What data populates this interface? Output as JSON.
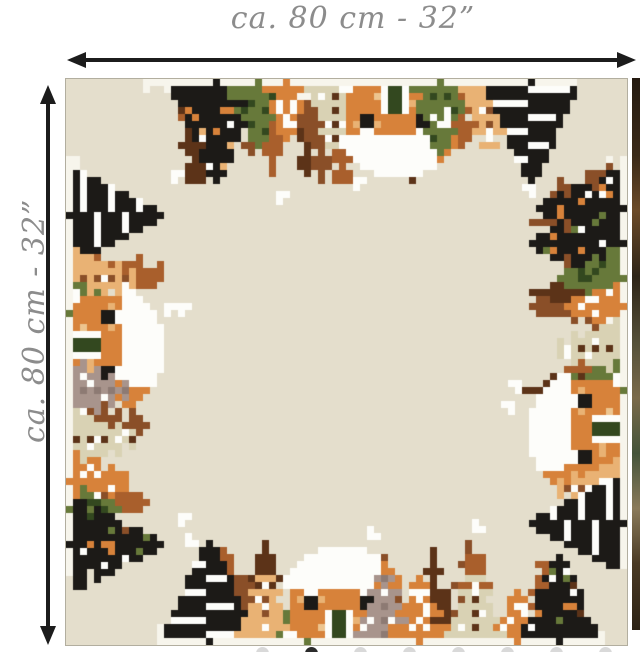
{
  "labels": {
    "width_label": "ca. 80 cm - 32”",
    "height_label": "ca. 80 cm - 32”",
    "label_color": "#8c8c8c"
  },
  "arrows": {
    "color": "#1c1c1c"
  },
  "cloth": {
    "background": "#e4decc",
    "border_color": "#b2ae9f",
    "palette": {
      "black": "#1c1a17",
      "white": "#fdfdfa",
      "snow": "#f7f5ec",
      "orange": "#d7823a",
      "tan": "#e9b274",
      "peach": "#edc58f",
      "beige": "#d9d2b4",
      "green": "#67793a",
      "darkgreen": "#33481f",
      "brown": "#8a4f28",
      "darkbrown": "#5c3318",
      "rust": "#a95f2c",
      "mauve": "#a8948c",
      "darkmauve": "#8d7a73"
    },
    "edges": {
      "top": {
        "seed": 11,
        "band": [
          0.17,
          0.88
        ],
        "fuzz": 16,
        "motifs": [
          {
            "type": "fir",
            "at": 0.26,
            "s": 1.1,
            "color": "black",
            "dots": [
              "orange",
              "white",
              "tan"
            ]
          },
          {
            "type": "fir",
            "at": 0.335,
            "s": 0.7,
            "color": "green",
            "dots": [
              "darkgreen"
            ]
          },
          {
            "type": "fir",
            "at": 0.385,
            "s": 0.6,
            "color": "orange",
            "dots": [
              "white"
            ]
          },
          {
            "type": "layered",
            "at": 0.47,
            "s": 0.85,
            "color": "beige",
            "trunk": "darkbrown"
          },
          {
            "type": "house",
            "at": 0.585
          },
          {
            "type": "fir",
            "at": 0.665,
            "s": 0.8,
            "color": "green",
            "dots": [
              "darkgreen",
              "white"
            ]
          },
          {
            "type": "layered",
            "at": 0.745,
            "s": 0.85,
            "color": "tan",
            "trunk": "brown"
          },
          {
            "type": "striped",
            "at": 0.83,
            "s": 1.0
          }
        ]
      },
      "left": {
        "seed": 22,
        "band": [
          0.17,
          0.86
        ],
        "fuzz": 13,
        "motifs": [
          {
            "type": "striped",
            "at": 0.24,
            "s": 0.95
          },
          {
            "type": "layered",
            "at": 0.35,
            "s": 0.8,
            "color": "tan",
            "trunk": "brown"
          },
          {
            "type": "fir",
            "at": 0.41,
            "s": 0.7,
            "color": "green",
            "dots": [
              "darkgreen"
            ]
          },
          {
            "type": "house",
            "at": 0.47
          },
          {
            "type": "layered",
            "at": 0.555,
            "s": 0.75,
            "color": "mauve",
            "trunk": "darkmauve"
          },
          {
            "type": "layered",
            "at": 0.64,
            "s": 0.85,
            "color": "beige",
            "trunk": "darkbrown"
          },
          {
            "type": "fir",
            "at": 0.715,
            "s": 0.65,
            "color": "orange",
            "dots": [
              "white"
            ]
          },
          {
            "type": "fir",
            "at": 0.76,
            "s": 0.55,
            "color": "green",
            "dots": [
              "darkgreen"
            ]
          },
          {
            "type": "fir",
            "at": 0.825,
            "s": 1.0,
            "color": "black",
            "dots": [
              "orange",
              "white",
              "green"
            ]
          }
        ]
      },
      "right": {
        "seed": 33,
        "band": [
          0.17,
          0.84
        ],
        "fuzz": 13,
        "motifs": [
          {
            "type": "fir",
            "at": 0.225,
            "s": 0.9,
            "color": "black",
            "dots": [
              "orange",
              "white"
            ]
          },
          {
            "type": "fir",
            "at": 0.29,
            "s": 1.0,
            "color": "black",
            "dots": [
              "orange",
              "white",
              "green"
            ]
          },
          {
            "type": "fir",
            "at": 0.345,
            "s": 0.7,
            "color": "green",
            "dots": [
              "darkgreen"
            ]
          },
          {
            "type": "fir",
            "at": 0.395,
            "s": 0.6,
            "color": "orange",
            "dots": [
              "white"
            ]
          },
          {
            "type": "layered",
            "at": 0.47,
            "s": 0.8,
            "color": "beige",
            "trunk": "darkbrown"
          },
          {
            "type": "fir",
            "at": 0.555,
            "s": 0.75,
            "color": "green",
            "dots": [
              "darkgreen"
            ]
          },
          {
            "type": "house",
            "at": 0.625
          },
          {
            "type": "layered",
            "at": 0.72,
            "s": 0.8,
            "color": "tan",
            "trunk": "brown"
          },
          {
            "type": "striped",
            "at": 0.79,
            "s": 0.95
          }
        ]
      },
      "bottom": {
        "seed": 44,
        "band": [
          0.19,
          0.93
        ],
        "fuzz": 18,
        "motifs": [
          {
            "type": "striped",
            "at": 0.25,
            "s": 1.0
          },
          {
            "type": "layered",
            "at": 0.345,
            "s": 0.85,
            "color": "tan",
            "trunk": "brown"
          },
          {
            "type": "fir",
            "at": 0.43,
            "s": 0.75,
            "color": "green",
            "dots": [
              "darkgreen"
            ]
          },
          {
            "type": "house",
            "at": 0.49
          },
          {
            "type": "layered",
            "at": 0.565,
            "s": 0.8,
            "color": "mauve",
            "trunk": "darkmauve"
          },
          {
            "type": "fir",
            "at": 0.63,
            "s": 0.7,
            "color": "orange",
            "dots": [
              "white"
            ]
          },
          {
            "type": "layered",
            "at": 0.73,
            "s": 0.8,
            "color": "beige",
            "trunk": "darkbrown"
          },
          {
            "type": "fir",
            "at": 0.8,
            "s": 0.5,
            "color": "orange",
            "dots": [
              "white"
            ]
          },
          {
            "type": "fir",
            "at": 0.875,
            "s": 0.95,
            "color": "black",
            "dots": [
              "orange",
              "white",
              "green"
            ]
          }
        ]
      }
    }
  },
  "carousel": {
    "dot_count": 9,
    "active_index": 1,
    "dot_color": "#d9d9d9",
    "active_color": "#2b2b2b",
    "first_x": 256,
    "spacing": 49
  }
}
